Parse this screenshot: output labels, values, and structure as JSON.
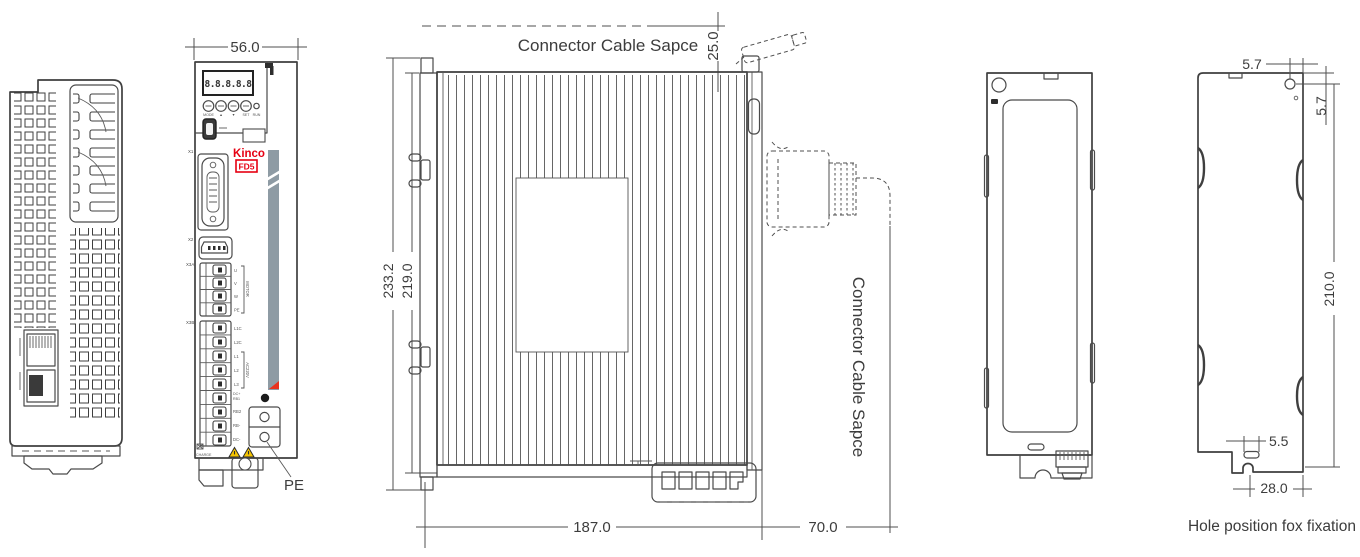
{
  "colors": {
    "background": "#ffffff",
    "line": "#4a4a4a",
    "text": "#3d3d3d",
    "brand_red": "#e60012",
    "heatsink_gray": "#8e9ba4",
    "warning_yellow": "#f6c500"
  },
  "brand": {
    "logo": "Kinco",
    "model": "FD5"
  },
  "front_view": {
    "dim_width": "56.0",
    "display_digits": "8.8.8.8.8",
    "buttons": {
      "b1": "MODE",
      "b2": "▲",
      "b3": "▼",
      "b4": "SET",
      "b5": "RUN"
    },
    "connectors": {
      "x1": "X1",
      "x2": "X2",
      "x3a": "X3A",
      "x3b": "X3B"
    },
    "terminals": {
      "u": "U",
      "v": "V",
      "w": "W",
      "pe": "PE",
      "motor_bracket": "MOTOR",
      "l1c": "L1C",
      "l2c": "L2C",
      "l1": "L1",
      "l2": "L2",
      "l3": "L3",
      "ac_bracket": "AC220V",
      "dc_plus": "DC+",
      "rb1": "RB1",
      "rb2": "RB2",
      "rb_minus": "RB-",
      "dc_minus": "DC-"
    },
    "charge_label": "CHARGE",
    "pe_callout": "PE"
  },
  "side_view": {
    "cable_space_top": "Connector Cable Sapce",
    "cable_space_right": "Connector Cable Sapce",
    "dim_top_clearance": "25.0",
    "dim_total_height": "233.2",
    "dim_body_height": "219.0",
    "dim_depth": "187.0",
    "dim_cable_clearance": "70.0"
  },
  "fixation_view": {
    "dim_hole_from_right": "5.7",
    "dim_hole_from_top": "5.7",
    "dim_hole_span": "210.0",
    "dim_slot_width": "5.5",
    "dim_slot_from_right": "28.0",
    "caption": "Hole position fox fixation"
  }
}
